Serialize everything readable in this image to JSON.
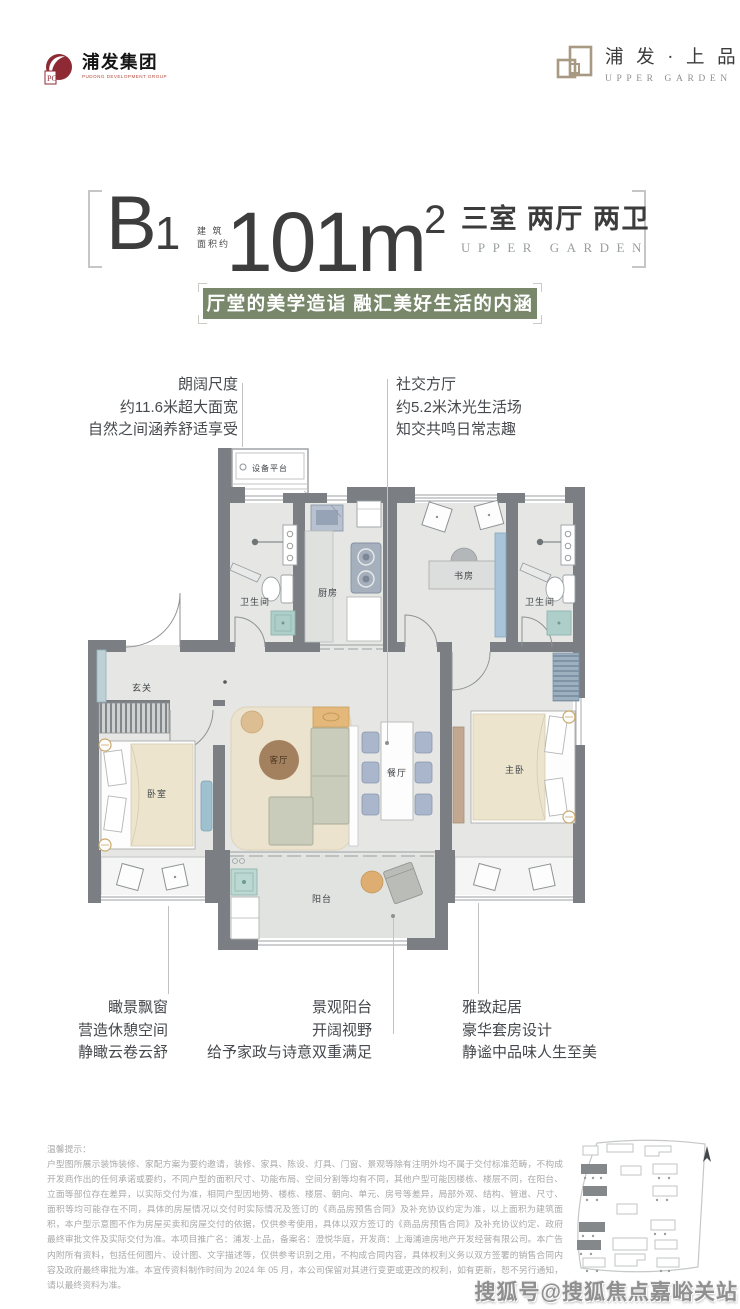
{
  "header": {
    "group_logo": {
      "title": "浦发集团",
      "subtitle": "PUDONG DEVELOPMENT GROUP",
      "mark_letters": "PG",
      "brand_color": "#8e2a33"
    },
    "brand_logo": {
      "title": "浦 发 · 上 品",
      "subtitle": "UPPER GARDEN",
      "brand_color": "#a89a82"
    }
  },
  "title_block": {
    "unit_letter": "B",
    "unit_number": "1",
    "area_prefix_line1": "建 筑",
    "area_prefix_line2": "面积约",
    "area_value": "101m",
    "area_superscript": "2",
    "layout_text": "三室 两厅 两卫",
    "layout_subtext": "UPPER GARDEN"
  },
  "banner": {
    "text": "厅堂的美学造诣 融汇美好生活的内涵",
    "bg_color": "#79886b"
  },
  "callouts": {
    "top_left": [
      "朗阔尺度",
      "约11.6米超大面宽",
      "自然之间涵养舒适享受"
    ],
    "top_right": [
      "社交方厅",
      "约5.2米沐光生活场",
      "知交共鸣日常志趣"
    ],
    "bottom_left": [
      "瞰景飘窗",
      "营造休憩空间",
      "静瞰云卷云舒"
    ],
    "bottom_center": [
      "景观阳台",
      "开阔视野",
      "给予家政与诗意双重满足"
    ],
    "bottom_right": [
      "雅致起居",
      "豪华套房设计",
      "静谧中品味人生至美"
    ]
  },
  "floorplan": {
    "labels": {
      "equipment_platform": "设备平台",
      "bathroom_left": "卫生间",
      "kitchen": "厨房",
      "study": "书房",
      "bathroom_right": "卫生间",
      "foyer": "玄关",
      "bedroom": "卧室",
      "living_room": "客厅",
      "dining_room": "餐厅",
      "master_bedroom": "主卧",
      "balcony": "阳台"
    },
    "colors": {
      "wall": "#7b7f83",
      "floor": "#e6e7e5",
      "rug": "#ece3cf",
      "rug_circle": "#a3815f",
      "bed_quilt": "#ece4cd",
      "sofa": "#c9ccba",
      "chair_blue": "#aab6cb",
      "teal_fixture": "#bcd8d2",
      "wood_table": "#ddad72"
    }
  },
  "disclaimer": {
    "title": "温馨提示：",
    "body": "户型图所展示装饰装修、家配方案为要约邀请，装修、家具、陈设、灯具、门窗、景观等除有注明外均不属于交付标准范畴，不构成开发商作出的任何承诺或要约，不同户型的面积尺寸、功能布局、空间分割等均有不同，其他户型可能因楼栋、楼层不同，在阳台、立面等部位存在差异，以实际交付为准，相同户型因地势、楼栋、楼层、朝向、单元、房号等差异，局部外观、结构、管道、尺寸、面积等均可能存在不同，具体的房屋情况以交付时实际情况及签订的《商品房预售合同》及补充协议约定为准，以上面积为建筑面积，本户型示意图不作为房屋买卖和房屋交付的依据，仅供参考使用，具体以双方签订的《商品房预售合同》及补充协议约定、政府最终审批文件及实际交付为准。本项目推广名：浦发·上品，备案名：澄悦华庭，开发商：上海浦迪房地产开发经营有限公司。本广告内附所有资料，包括任何图片、设计图、文字描述等，仅供参考识别之用，不构成合同内容，具体权利义务以双方签署的销售合同内容及政府最终审批为准。本宣传资料制作时间为 2024 年 05 月，本公司保留对其进行变更或更改的权利，如有更新，恕不另行通知，请以最终资料为准。"
  },
  "watermark": "搜狐号@搜狐焦点嘉峪关站"
}
